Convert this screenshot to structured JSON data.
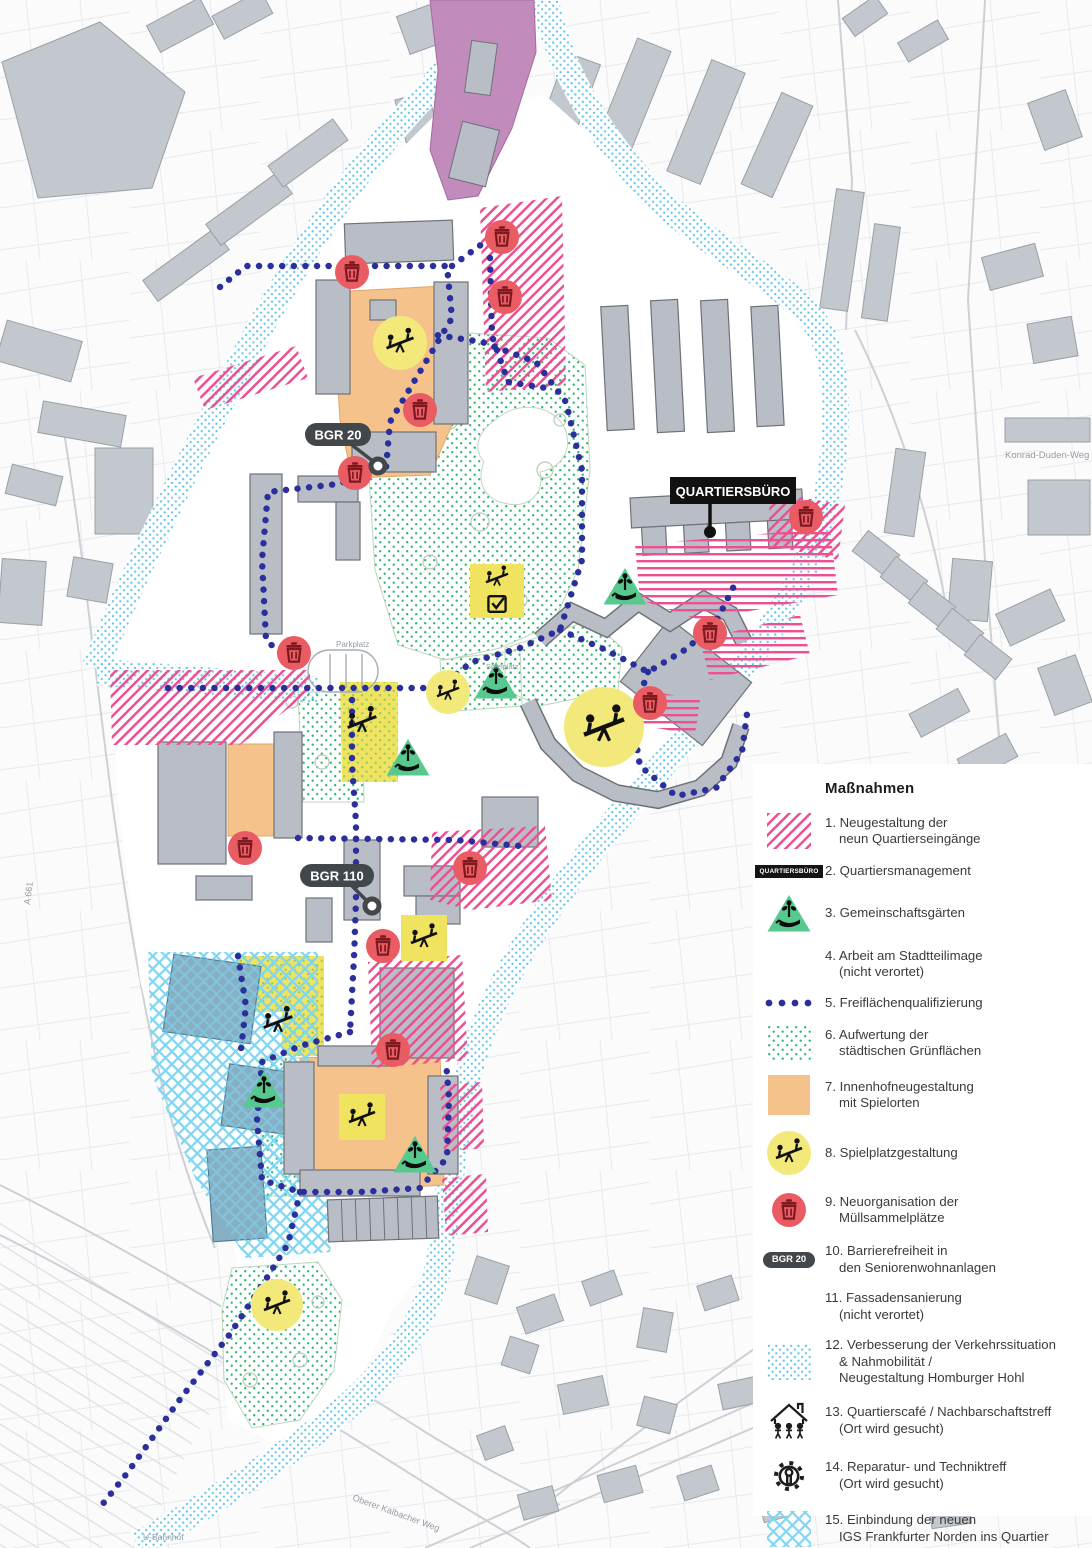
{
  "legend": {
    "title": "Maßnahmen",
    "items": [
      {
        "num": 1,
        "icon": "hatch-pink",
        "lines": [
          "1. Neugestaltung der",
          "neun Quartierseingänge"
        ]
      },
      {
        "num": 2,
        "icon": "pill-qb",
        "icon_label": "QUARTIERSBÜRO",
        "lines": [
          "2. Quartiersmanagement"
        ]
      },
      {
        "num": 3,
        "icon": "garden",
        "lines": [
          "3. Gemeinschaftsgärten"
        ]
      },
      {
        "num": 4,
        "icon": "none",
        "lines": [
          "4. Arbeit am Stadtteilimage",
          "(nicht verortet)"
        ]
      },
      {
        "num": 5,
        "icon": "dots-row",
        "lines": [
          "5. Freiflächenqualifizierung"
        ]
      },
      {
        "num": 6,
        "icon": "dots-green",
        "lines": [
          "6. Aufwertung der",
          "städtischen Grünflächen"
        ]
      },
      {
        "num": 7,
        "icon": "solid-orange",
        "lines": [
          "7. Innenhofneugestaltung",
          "mit Spielorten"
        ]
      },
      {
        "num": 8,
        "icon": "play-circle",
        "lines": [
          "8. Spielplatzgestaltung"
        ]
      },
      {
        "num": 9,
        "icon": "trash-circle",
        "lines": [
          "9. Neuorganisation der",
          "Müllsammelplätze"
        ]
      },
      {
        "num": 10,
        "icon": "pill-bgr",
        "icon_label": "BGR 20",
        "lines": [
          "10. Barrierefreiheit in",
          "den Seniorenwohnanlagen"
        ]
      },
      {
        "num": 11,
        "icon": "none",
        "lines": [
          "11. Fassadensanierung",
          "(nicht verortet)"
        ]
      },
      {
        "num": 12,
        "icon": "dots-cyan",
        "lines": [
          "12. Verbesserung der Verkehrssituation",
          "& Nahmobilität /",
          "Neugestaltung Homburger Hohl"
        ]
      },
      {
        "num": 13,
        "icon": "house",
        "lines": [
          "13. Quartierscafé / Nachbarschaftstreff",
          "(Ort wird gesucht)"
        ]
      },
      {
        "num": 14,
        "icon": "gear",
        "lines": [
          "14. Reparatur- und Techniktreff",
          "(Ort wird gesucht)"
        ]
      },
      {
        "num": 15,
        "icon": "cross-cyan",
        "lines": [
          "15. Einbindung der neuen",
          "IGS Frankfurter Norden ins Quartier"
        ]
      },
      {
        "num": 16,
        "icon": "solid-purple",
        "lines": [
          "16. Gestaltung Freiflächen Jugendhaus"
        ]
      }
    ]
  },
  "map": {
    "labels": {
      "bgr20": "BGR 20",
      "bgr110": "BGR 110",
      "quartiersbuero": "QUARTIERSBÜRO",
      "street_konrad": "Konrad-Duden-Weg",
      "street_oberer": "Oberer Kalbacher Weg",
      "ubahnhof": "U-Bahnhof",
      "parkplatz": "Parkplatz",
      "spielplatz": "Spielplatz",
      "a661": "A 661"
    },
    "markers": {
      "trash": [
        [
          352,
          272
        ],
        [
          502,
          237
        ],
        [
          505,
          297
        ],
        [
          420,
          410
        ],
        [
          355,
          473
        ],
        [
          806,
          517
        ],
        [
          294,
          653
        ],
        [
          710,
          633
        ],
        [
          650,
          703
        ],
        [
          245,
          848
        ],
        [
          470,
          868
        ],
        [
          383,
          946
        ],
        [
          393,
          1050
        ]
      ],
      "play_circles": [
        [
          400,
          343,
          27
        ],
        [
          604,
          727,
          40
        ],
        [
          448,
          692,
          22
        ],
        [
          277,
          1305,
          26
        ]
      ],
      "play_squares": [
        [
          424,
          938,
          46
        ],
        [
          362,
          1117,
          46
        ]
      ],
      "play_square_check": [
        [
          497,
          591,
          54
        ]
      ],
      "play_icons": [
        [
          278,
          1022
        ],
        [
          362,
          722
        ]
      ],
      "gardens": [
        [
          625,
          589
        ],
        [
          496,
          683
        ],
        [
          408,
          760
        ],
        [
          264,
          1092
        ],
        [
          415,
          1157
        ]
      ]
    }
  },
  "colors": {
    "pink": "#ec4f92",
    "navy_dots": "#2b2f9b",
    "green_dots": "#2fb56e",
    "garden_green": "#57c98e",
    "orange": "#f6c28b",
    "yellow": "#f3e97b",
    "red_circle": "#e95c63",
    "red_glyph": "#7d1a20",
    "cyan_band": "#5ec4e8",
    "cyan_cross": "#7fd6f0",
    "purple": "#c18cbb",
    "pill_dark": "#42474b",
    "building_gray": "#b9bec6"
  }
}
